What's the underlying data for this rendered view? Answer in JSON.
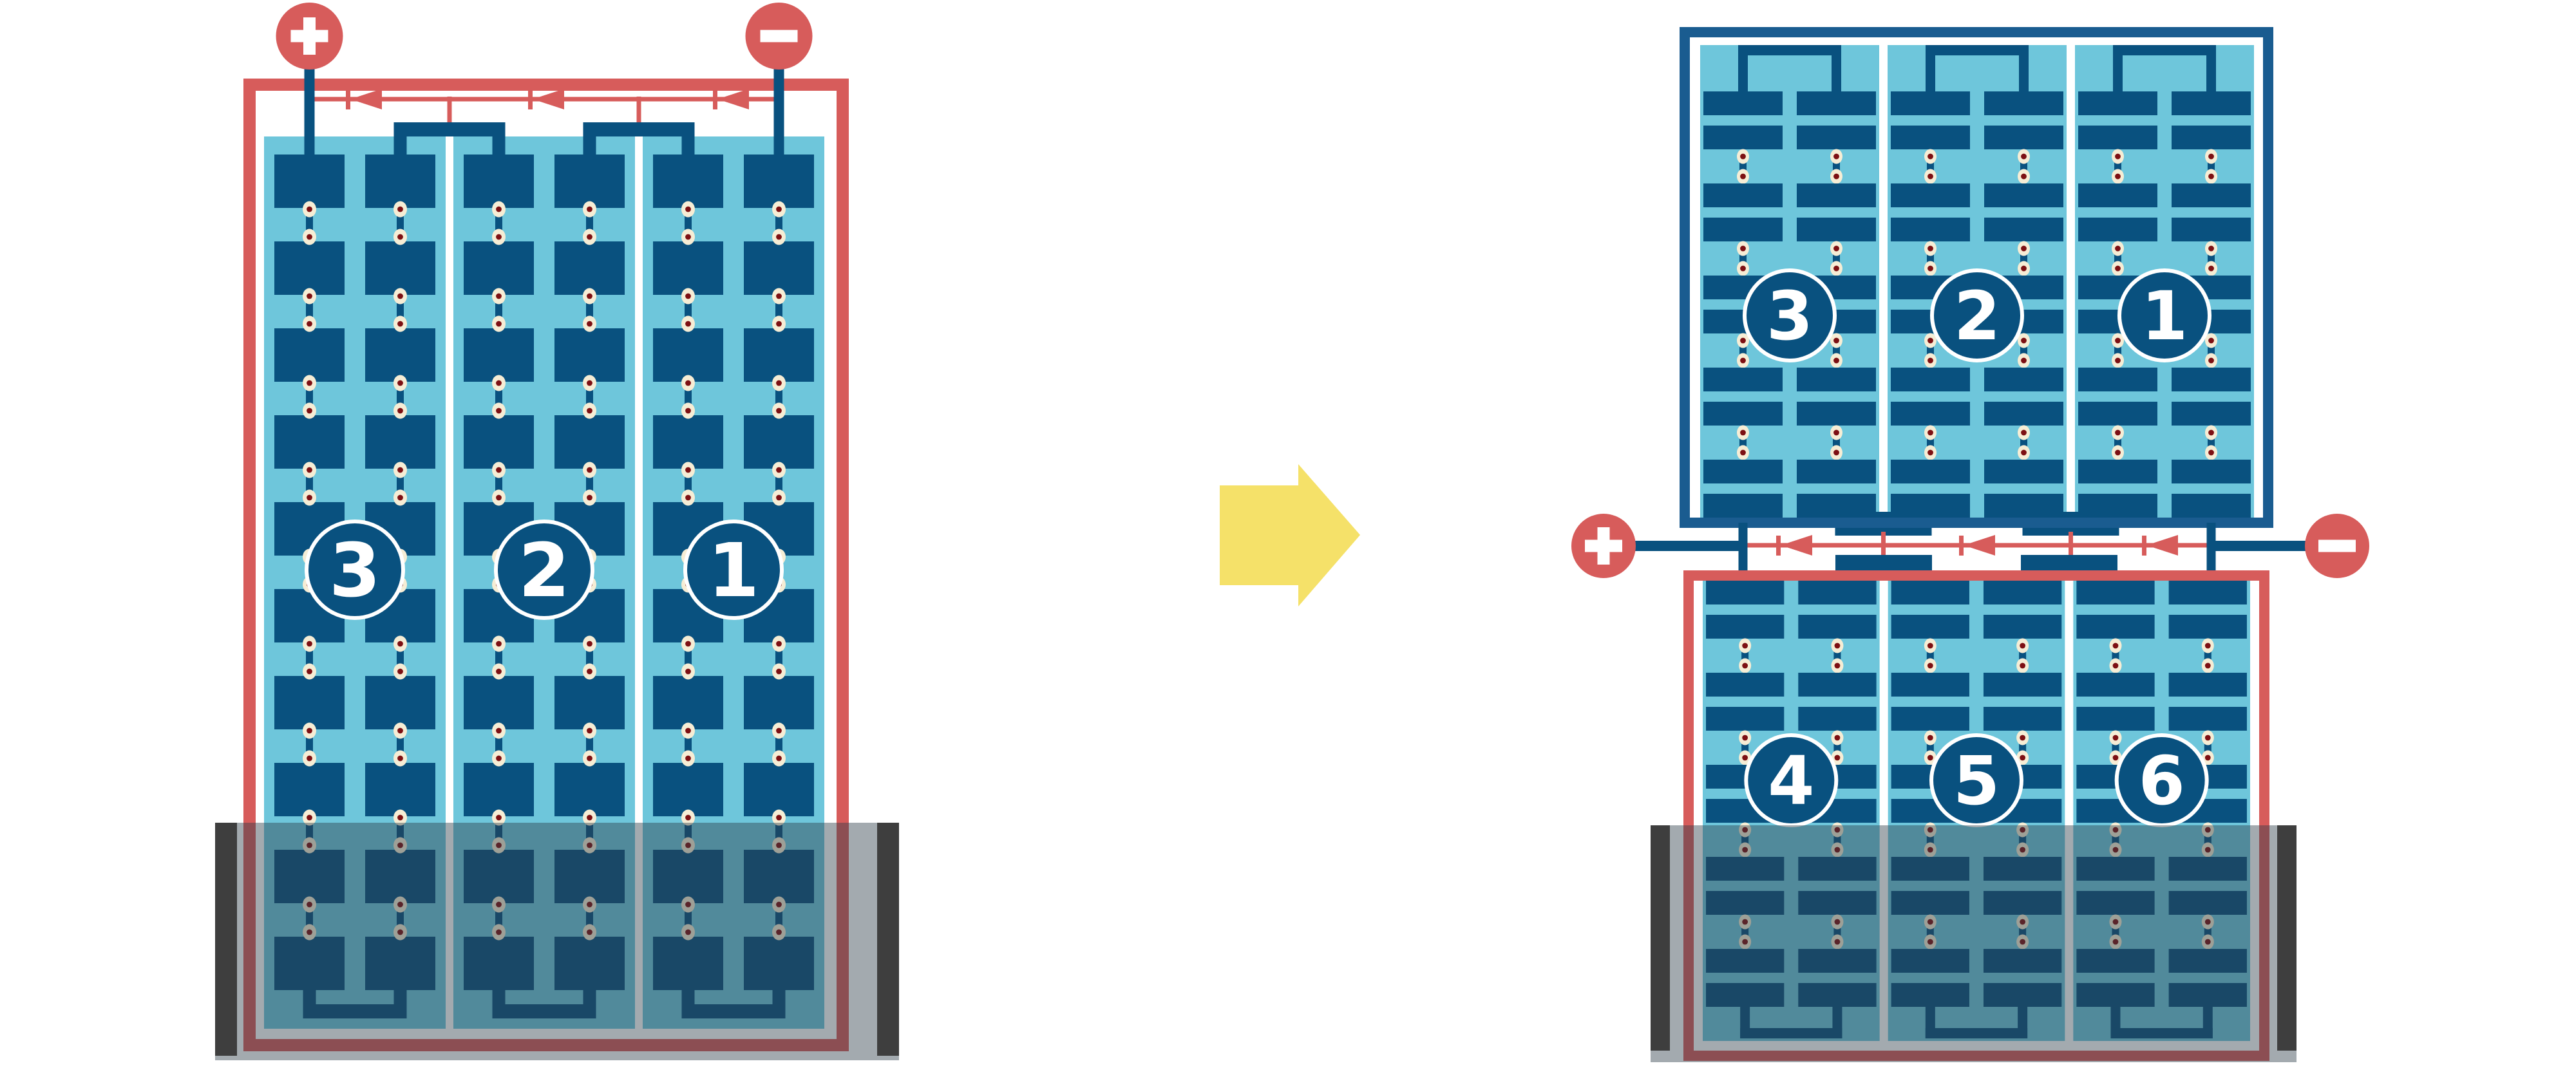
{
  "diagram": {
    "kind": "solar-module-bypass-diode-wiring",
    "background": "#ffffff"
  },
  "colors": {
    "red": "#D75C5B",
    "navy": "#09517F",
    "frame_navy": "#1A5C90",
    "light_blue": "#6EC6DB",
    "cream": "#F6EDD5",
    "dot_red": "#7D1013",
    "shade_overlay": "rgba(45,62,72,0.44)",
    "shade_bar": "#3E3E3E",
    "arrow_yellow": "#F5E169",
    "white": "#FFFFFF"
  },
  "left_module": {
    "terminals": [
      {
        "polarity": "positive",
        "symbol": "+"
      },
      {
        "polarity": "negative",
        "symbol": "−"
      }
    ],
    "bypass_diode_count": 3,
    "strings": [
      {
        "label": "3"
      },
      {
        "label": "2"
      },
      {
        "label": "1"
      }
    ],
    "shaded_bottom": true
  },
  "arrow": {
    "direction": "right"
  },
  "right_stack": {
    "terminals": [
      {
        "polarity": "positive",
        "symbol": "+"
      },
      {
        "polarity": "negative",
        "symbol": "−"
      }
    ],
    "bypass_diode_count": 3,
    "top_module": {
      "strings": [
        {
          "label": "3"
        },
        {
          "label": "2"
        },
        {
          "label": "1"
        }
      ]
    },
    "bottom_module": {
      "strings": [
        {
          "label": "4"
        },
        {
          "label": "5"
        },
        {
          "label": "6"
        }
      ],
      "shaded_bottom": true
    }
  }
}
